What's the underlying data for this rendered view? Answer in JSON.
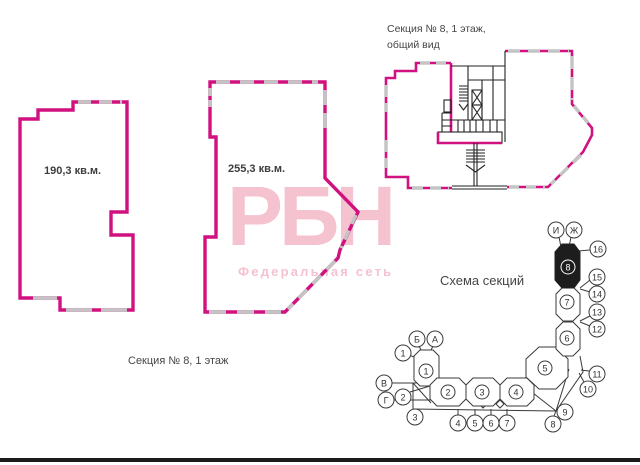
{
  "colors": {
    "wall_magenta": "#d0117f",
    "window_gray": "#c4c4c4",
    "core_black": "#222222",
    "text_gray": "#454545",
    "watermark_pink": "#f5c2cf",
    "highlight_black": "#1d1d1d"
  },
  "plans": [
    {
      "area": "190,3 кв.м."
    },
    {
      "area": "255,3 кв.м."
    }
  ],
  "overview": {
    "title_line1": "Секция № 8, 1 этаж,",
    "title_line2": "общий вид"
  },
  "footer": {
    "label": "Секция № 8, 1 этаж"
  },
  "watermark": {
    "logo": "РБН",
    "subtitle": "Федеральная сеть"
  },
  "scheme": {
    "title": "Схема секций",
    "highlighted_section": "8",
    "sections": [
      {
        "label": "1"
      },
      {
        "label": "2"
      },
      {
        "label": "3"
      },
      {
        "label": "4"
      },
      {
        "label": "5"
      },
      {
        "label": "6"
      },
      {
        "label": "7"
      },
      {
        "label": "8"
      }
    ],
    "axes": [
      {
        "label": "И"
      },
      {
        "label": "Ж"
      },
      {
        "label": "16"
      },
      {
        "label": "15"
      },
      {
        "label": "14"
      },
      {
        "label": "13"
      },
      {
        "label": "12"
      },
      {
        "label": "11"
      },
      {
        "label": "10"
      },
      {
        "label": "9"
      },
      {
        "label": "8"
      },
      {
        "label": "7"
      },
      {
        "label": "6"
      },
      {
        "label": "5"
      },
      {
        "label": "4"
      },
      {
        "label": "3"
      },
      {
        "label": "2"
      },
      {
        "label": "Г"
      },
      {
        "label": "В"
      },
      {
        "label": "1"
      },
      {
        "label": "Б"
      },
      {
        "label": "А"
      }
    ]
  }
}
